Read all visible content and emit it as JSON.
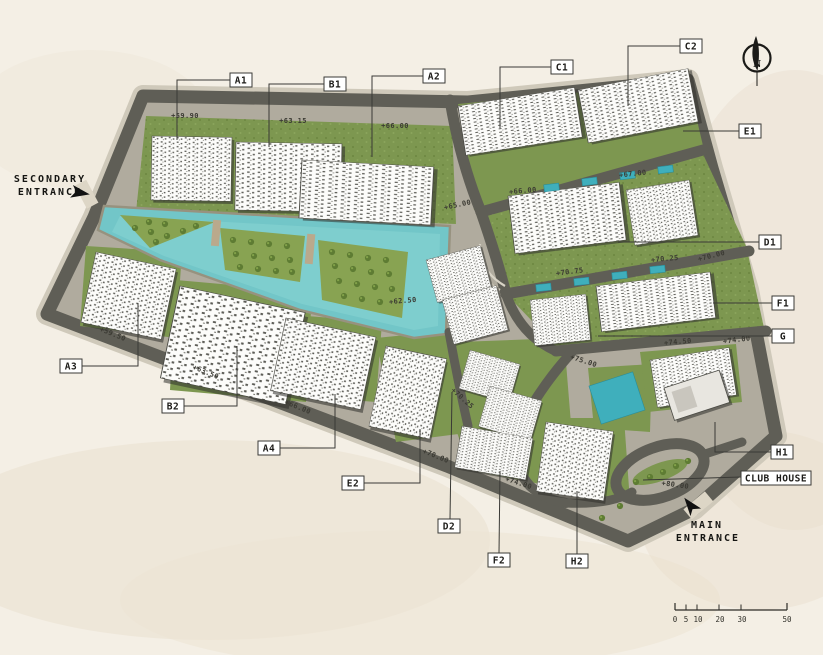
{
  "plan": {
    "blocks": [
      "A1",
      "B1",
      "A2",
      "C1",
      "C2",
      "E1",
      "D1",
      "F1",
      "G",
      "H1",
      "A3",
      "B2",
      "A4",
      "E2",
      "D2",
      "F2",
      "H2"
    ],
    "club_house": "CLUB HOUSE",
    "entrances": {
      "secondary_line1": "SECONDARY",
      "secondary_line2": "ENTRANCE",
      "main_line1": "MAIN",
      "main_line2": "ENTRANCE"
    },
    "elevations": [
      "+59.90",
      "+63.15",
      "+66.00",
      "+65.00",
      "+66.00",
      "+67.00",
      "+70.00",
      "+70.25",
      "+70.75",
      "+74.50",
      "+74.00",
      "+75.00",
      "+62.50",
      "+59.50",
      "+63.50",
      "+66.00",
      "+70.00",
      "+70.25",
      "+74.00",
      "+80.00"
    ],
    "compass": {
      "north": "N"
    },
    "scale_bar": {
      "ticks": [
        "0",
        "5",
        "10",
        "20",
        "30",
        "50"
      ]
    },
    "colors": {
      "paper": "#f4efe5",
      "road": "#5f5e56",
      "sidewalk": "#cfc9ba",
      "green": "#7d9750",
      "water": "#72c6c8",
      "pool": "#3fafbc",
      "building": "#fcfcfa"
    }
  }
}
